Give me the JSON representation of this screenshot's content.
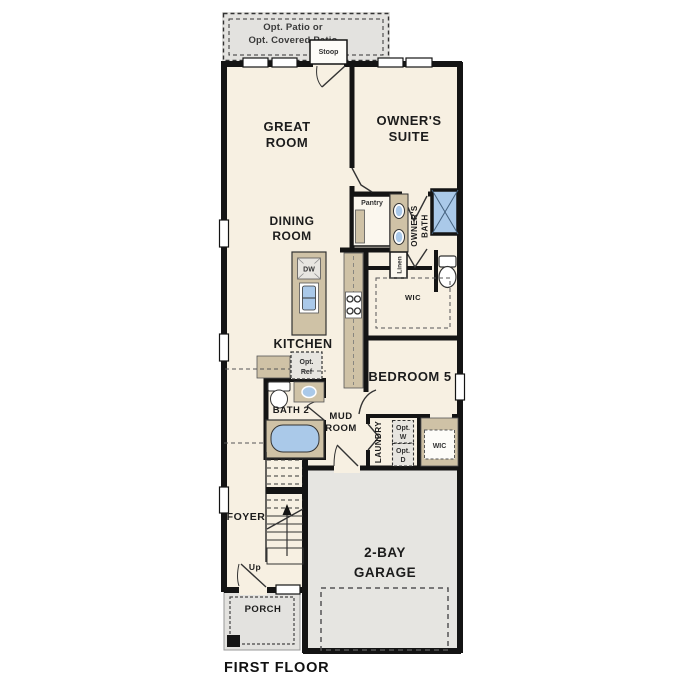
{
  "title": "FIRST FLOOR",
  "colors": {
    "floor": "#f7f0e2",
    "garage_floor": "#e6e5e1",
    "patio_floor": "#e3e2df",
    "counter_tan": "#cfc2a6",
    "fixture_blue": "#aac9e9",
    "wall_black": "#141414"
  },
  "rooms": {
    "patio": {
      "line1": "Opt. Patio or",
      "line2": "Opt. Covered Patio"
    },
    "stoop": "Stoop",
    "great_room": {
      "line1": "GREAT",
      "line2": "ROOM"
    },
    "owners_suite": {
      "line1": "OWNER'S",
      "line2": "SUITE"
    },
    "dining_room": {
      "line1": "DINING",
      "line2": "ROOM"
    },
    "pantry": "Pantry",
    "owners_bath": {
      "line1": "OWNER'S",
      "line2": "BATH"
    },
    "linen": "Linen",
    "wic_owners": "WIC",
    "kitchen": "KITCHEN",
    "dishwasher": "DW",
    "opt_ref": {
      "line1": "Opt.",
      "line2": "Ref"
    },
    "bath2": "BATH 2",
    "mud_room": {
      "line1": "MUD",
      "line2": "ROOM"
    },
    "bedroom5": "BEDROOM 5",
    "laundry": "LAUNDRY",
    "opt_washer": {
      "line1": "Opt.",
      "line2": "W"
    },
    "opt_dryer": {
      "line1": "Opt.",
      "line2": "D"
    },
    "wic_hall": "WIC",
    "foyer": "FOYER",
    "up": "Up",
    "garage": {
      "line1": "2-BAY",
      "line2": "GARAGE"
    },
    "porch": "PORCH"
  }
}
